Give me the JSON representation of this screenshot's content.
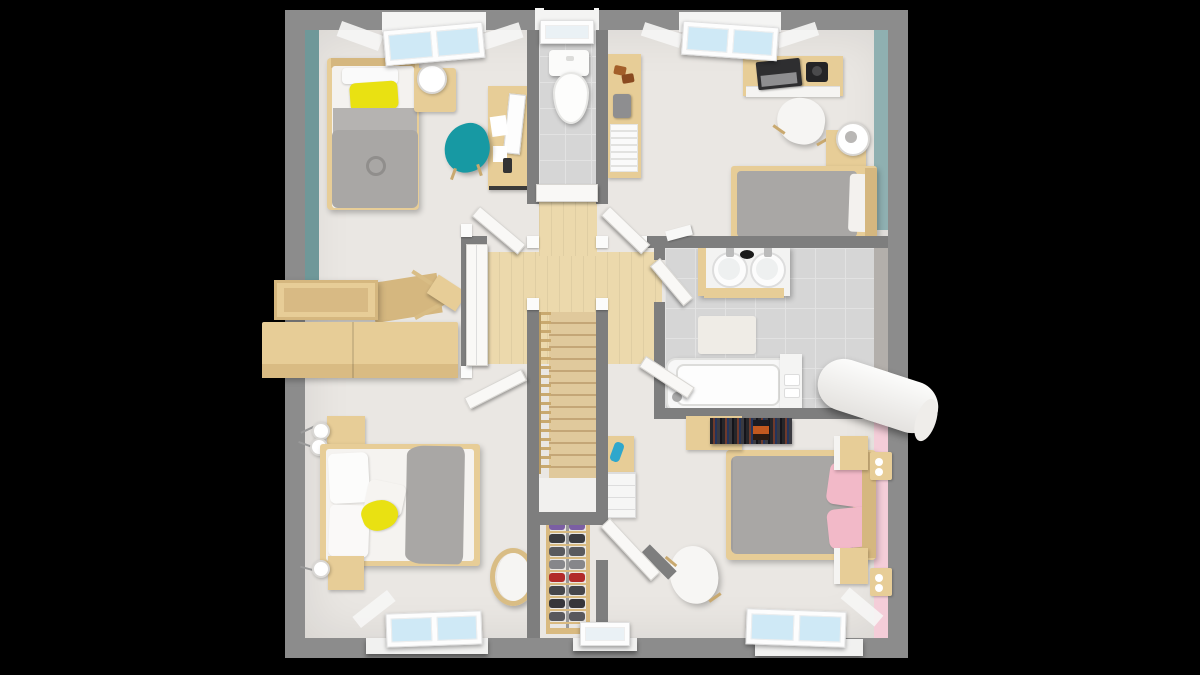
{
  "scene": {
    "title": "3D top-down floor plan render of an upper storey",
    "background_color": "#000000",
    "style": "photoreal dollhouse view, furniture visible, walls cut at ceiling"
  },
  "palette": {
    "outer_wall": "#8c8c8c",
    "partition_wall": "#7e7e7e",
    "floor": "#eae7e3",
    "wood_floor": "#ecd9ac",
    "stair_wood": "#e0c99c",
    "stair_line": "#c4a677",
    "tile_floor": "#d6d6d6",
    "tile_line": "#e2e2e2",
    "teal_wall": "#6f9899",
    "teal_wall_light": "#8fb0b1",
    "pink_wall": "#f4cdd8",
    "wood_furniture": "#e7cd97",
    "wood_furniture_dark": "#d5b77f",
    "white_furniture": "#f7f6f5",
    "gray_fabric": "#a9a7a5",
    "gray_fabric_dark": "#97938f",
    "yellow": "#e9e112",
    "teal_chair": "#1799a3",
    "pink_fabric": "#f2b9c8",
    "glass": "#cfe9f6",
    "laptop": "#2e2e30",
    "metal": "#9a9a9a"
  },
  "rooms": [
    {
      "id": "bedroom-top-left",
      "accent_wall": "teal west wall",
      "items": [
        "single-bed with yellow pillow and gray duvet",
        "nightstand with lamp",
        "desk with monitor, papers, phone",
        "teal armchair",
        "open storage box",
        "wooden chest",
        "folding chair",
        "double roof window"
      ]
    },
    {
      "id": "wc",
      "items": [
        "toilet",
        "gray tile floor",
        "small roof window",
        "white door"
      ]
    },
    {
      "id": "bedroom-top-right",
      "accent_wall": "teal east wall",
      "items": [
        "sideboard with books and camera",
        "desk with laptop and camera",
        "white chair",
        "nightstand with lamp",
        "double bed",
        "double roof window"
      ]
    },
    {
      "id": "landing",
      "items": [
        "wooden floor",
        "staircase with railing",
        "five open white doors"
      ]
    },
    {
      "id": "bathroom",
      "items": [
        "double sink vanity",
        "bath mat",
        "bathtub",
        "side tray",
        "rolled white mat crossing east wall",
        "gray tile floor"
      ]
    },
    {
      "id": "bedroom-bottom-left",
      "items": [
        "double bed with gray throw and yellow cushion",
        "two nightstands with ball lamps",
        "round rattan chair",
        "window"
      ]
    },
    {
      "id": "closet",
      "items": [
        "shoe rack",
        "small window"
      ]
    },
    {
      "id": "bedroom-bottom-right",
      "accent_wall": "pink east wall",
      "items": [
        "double bed with pink pillows",
        "two nightstands",
        "two wall shelves",
        "media shelf with books",
        "white shell chair",
        "drawer unit with blue bag",
        "window"
      ]
    }
  ],
  "closet": {
    "shoe_rows": [
      "#7b5fa3",
      "#3c3c40",
      "#5a5a5e",
      "#86868a",
      "#b22a2a",
      "#46464a",
      "#36363a",
      "#59595d"
    ]
  }
}
